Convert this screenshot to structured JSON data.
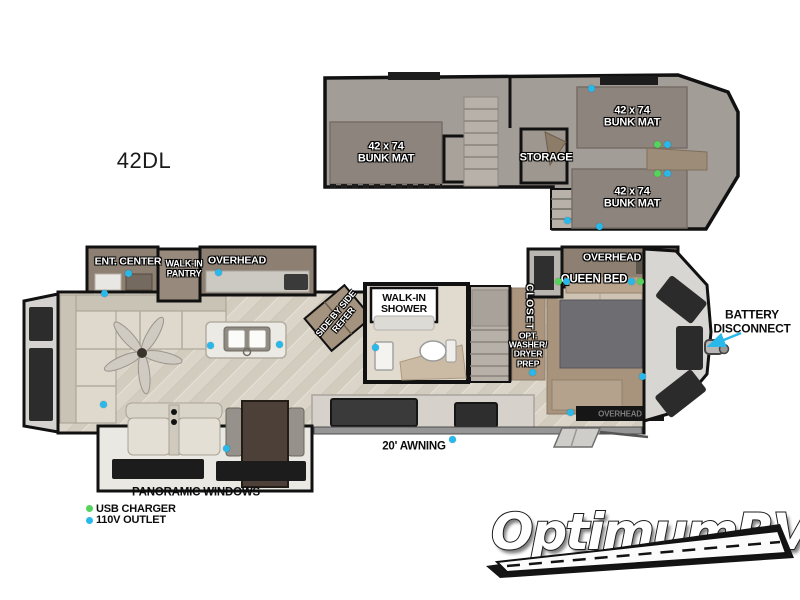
{
  "model_label": "42DL",
  "colors": {
    "outlet": "#29b8ea",
    "usb": "#55d45c",
    "wall": "#111111",
    "loft_floor": "#a39d97",
    "bunk_mat": "#8d857d",
    "wood_floor": "#dbd5c9",
    "cabinet": "#8d8073",
    "accent_arrow": "#29b8ea"
  },
  "loft": {
    "bunk_mats": [
      {
        "size": "42 x 74",
        "label": "BUNK MAT"
      },
      {
        "size": "42 x 74",
        "label": "BUNK MAT"
      },
      {
        "size": "42 x 74",
        "label": "BUNK MAT"
      }
    ],
    "storage": "STORAGE"
  },
  "main": {
    "ent_center": "ENT. CENTER",
    "pantry": [
      "WALK-IN",
      "PANTRY"
    ],
    "overhead_kitchen": "OVERHEAD",
    "overhead_bedroom": "OVERHEAD",
    "overhead_bed_base": "OVERHEAD",
    "queen_bed": "QUEEN BED",
    "shower": [
      "WALK-IN",
      "SHOWER"
    ],
    "refer": [
      "SIDE BY SIDE",
      "REFER"
    ],
    "closet": "CLOSET",
    "washer": [
      "OPT.",
      "WASHER/",
      "DRYER",
      "PREP"
    ],
    "battery": [
      "BATTERY",
      "DISCONNECT"
    ],
    "awning": "20' AWNING",
    "panoramic": "PANORAMIC WINDOWS"
  },
  "legend": {
    "usb": "USB CHARGER",
    "outlet": "110V OUTLET"
  },
  "watermark": {
    "text": "OptimumRV"
  }
}
